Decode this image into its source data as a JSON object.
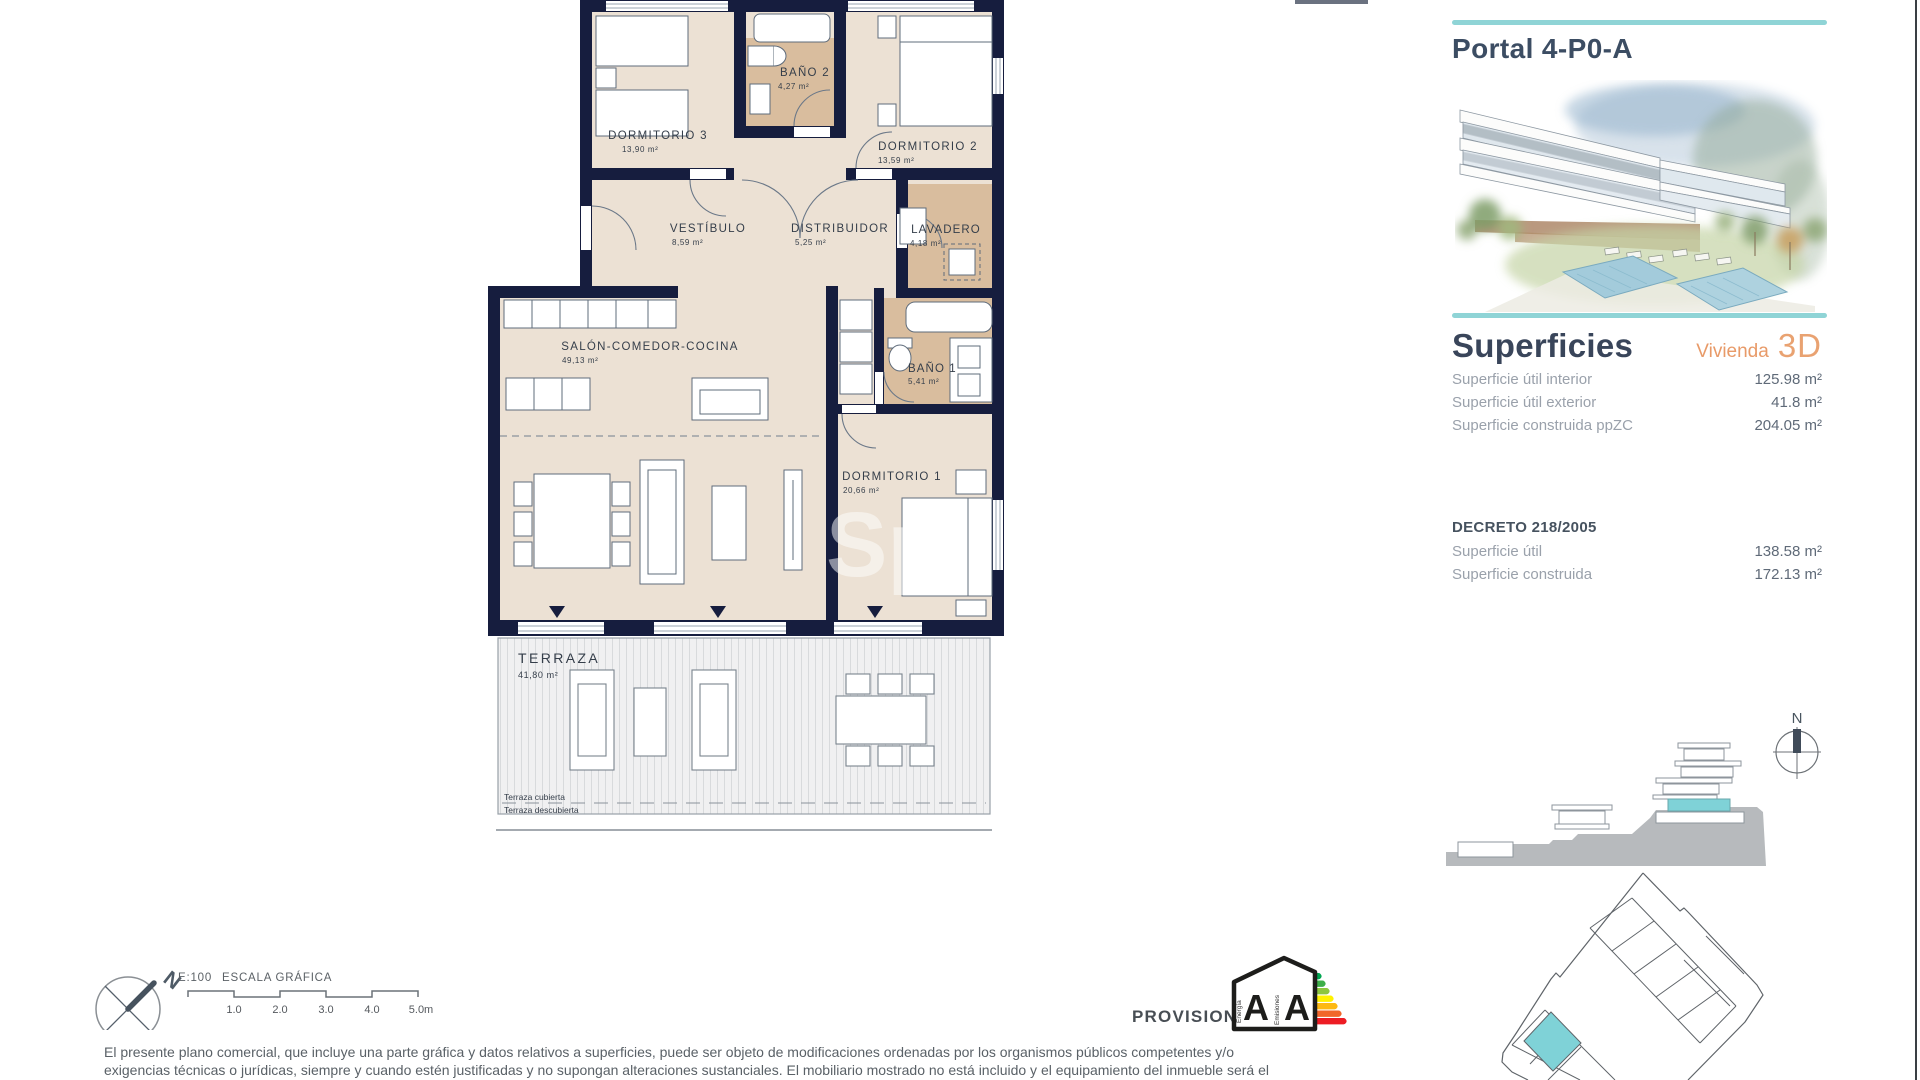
{
  "panel": {
    "title": "Portal 4-P0-A",
    "superficies": {
      "heading": "Superficies",
      "vivienda_label": "Vivienda",
      "vivienda_value": "3D",
      "rows": [
        {
          "label": "Superficie útil interior",
          "value": "125.98 m²"
        },
        {
          "label": "Superficie útil exterior",
          "value": "41.8 m²"
        },
        {
          "label": "Superficie construida ppZC",
          "value": "204.05 m²"
        }
      ]
    },
    "decreto": {
      "heading": "DECRETO 218/2005",
      "rows": [
        {
          "label": "Superficie útil",
          "value": "138.58 m²"
        },
        {
          "label": "Superficie construida",
          "value": "172.13 m²"
        }
      ]
    },
    "compass_north": "N"
  },
  "plan": {
    "rooms": [
      {
        "name": "DORMITORIO 3",
        "area": "13,90 m²"
      },
      {
        "name": "BAÑO 2",
        "area": "4,27 m²"
      },
      {
        "name": "DORMITORIO 2",
        "area": "13,59 m²"
      },
      {
        "name": "VESTÍBULO",
        "area": "8,59 m²"
      },
      {
        "name": "DISTRIBUIDOR",
        "area": "5,25 m²"
      },
      {
        "name": "LAVADERO",
        "area": "4,18 m²"
      },
      {
        "name": "SALÓN-COMEDOR-COCINA",
        "area": "49,13 m²"
      },
      {
        "name": "BAÑO 1",
        "area": "5,41 m²"
      },
      {
        "name": "DORMITORIO 1",
        "area": "20,66 m²"
      },
      {
        "name": "TERRAZA",
        "area": "41,80 m²"
      }
    ],
    "terrace_notes": [
      "Terraza cubierta",
      "Terraza descubierta"
    ],
    "watermark": "Sp"
  },
  "footer": {
    "scale_ratio": "E:100",
    "scale_title": "ESCALA GRÁFICA",
    "ticks": [
      "1.0",
      "2.0",
      "3.0",
      "4.0",
      "5.0m"
    ],
    "compass_north": "N",
    "provisional": "PROVISIONAL"
  },
  "energy": {
    "letters": [
      "A",
      "A"
    ],
    "energia": "Energía",
    "emisiones": "Emisiones"
  },
  "disclaimer": {
    "line1": "El presente plano comercial, que incluye una parte gráfica y datos relativos a superficies, puede ser objeto de modificaciones ordenadas por los organismos públicos competentes y/o",
    "line2": "exigencias técnicas o jurídicas, siempre y cuando estén justificadas y no supongan alteraciones sustanciales. El mobiliario mostrado no está incluido y el equipamiento del inmueble será el"
  },
  "colors": {
    "wall": "#161d3e",
    "room": "#ece1d4",
    "bath": "#d9bd9e",
    "teal_accent": "#8fd4d6",
    "orange_accent": "#e89a68",
    "title_slate": "#39455a",
    "highlight_unit": "#7fd2d7"
  }
}
